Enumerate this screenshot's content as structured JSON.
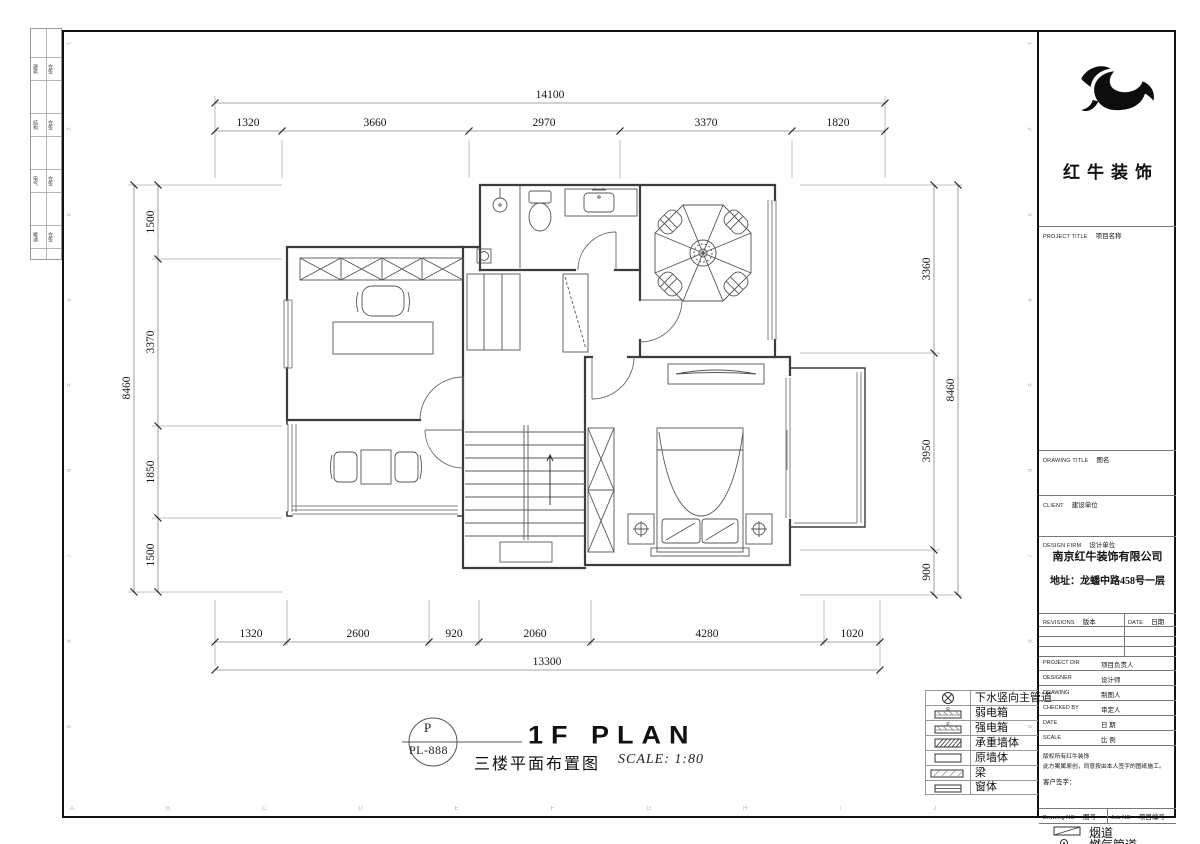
{
  "sheet": {
    "brand": "红牛装饰",
    "stamp_letter": "P",
    "stamp_code": "PL-888",
    "title_en": "1F PLAN",
    "title_cn": "三楼平面布置图",
    "scale_note": "SCALE: 1:80"
  },
  "dimensions": {
    "top": {
      "total": "14100",
      "segments": [
        "1320",
        "3660",
        "2970",
        "3370",
        "1820"
      ]
    },
    "bottom": {
      "total": "13300",
      "segments": [
        "1320",
        "2600",
        "920",
        "2060",
        "4280",
        "1020"
      ]
    },
    "left": {
      "total": "8460",
      "segments": [
        "1500",
        "3370",
        "1850",
        "1500"
      ]
    },
    "right": {
      "total": "8460",
      "segments": [
        "3360",
        "3950",
        "900"
      ]
    }
  },
  "legend": {
    "items": [
      {
        "label": "下水竖向主管道"
      },
      {
        "label": "弱电箱",
        "letter": "R"
      },
      {
        "label": "强电箱",
        "letter": "P"
      },
      {
        "label": "承重墙体"
      },
      {
        "label": "原墙体"
      },
      {
        "label": "梁"
      },
      {
        "label": "窗体"
      },
      {
        "label": "烟道"
      },
      {
        "label": "燃气管道"
      }
    ]
  },
  "title_block": {
    "project_title_en": "PROJECT TITLE",
    "project_title_cn": "项目名称",
    "drawing_title_en": "DRAWING TITLE",
    "drawing_title_cn": "图名",
    "client_en": "CLIENT",
    "client_cn": "建设单位",
    "design_firm_en": "DESIGN FIRM",
    "design_firm_cn": "设计单位",
    "firm_name": "南京红牛装饰有限公司",
    "firm_address": "地址：龙蟠中路458号一层",
    "revisions_en": "REVISIONS",
    "revisions_cn": "版本",
    "date_col_en": "DATE",
    "date_col_cn": "日期",
    "rows": [
      {
        "en": "PROJECT DIR",
        "cn": "项目负责人"
      },
      {
        "en": "DESIGNER",
        "cn": "设计师"
      },
      {
        "en": "DRAWING",
        "cn": "制图人"
      },
      {
        "en": "CHECKED BY",
        "cn": "审定人"
      },
      {
        "en": "DATE",
        "cn": "日 期"
      },
      {
        "en": "SCALE",
        "cn": "比 例"
      }
    ],
    "copyright_line1": "版权所有红牛装饰",
    "copyright_line2": "此方案属原创，同意按由本人签字的图纸施工。",
    "client_sign": "客户签字：",
    "drawing_no_en": "Drawing NO",
    "drawing_no_cn": "图号",
    "job_no_en": "Job NO",
    "job_no_cn": "项目编号"
  },
  "binding_strip": {
    "cells": [
      {
        "a": "建筑",
        "b": "会签"
      },
      {
        "a": "结构",
        "b": "会签"
      },
      {
        "a": "电气",
        "b": "会签"
      },
      {
        "a": "暖通",
        "b": "会签"
      }
    ]
  },
  "grid": {
    "letters": "ABCDEFGHIJ",
    "numbers": "123456789"
  }
}
